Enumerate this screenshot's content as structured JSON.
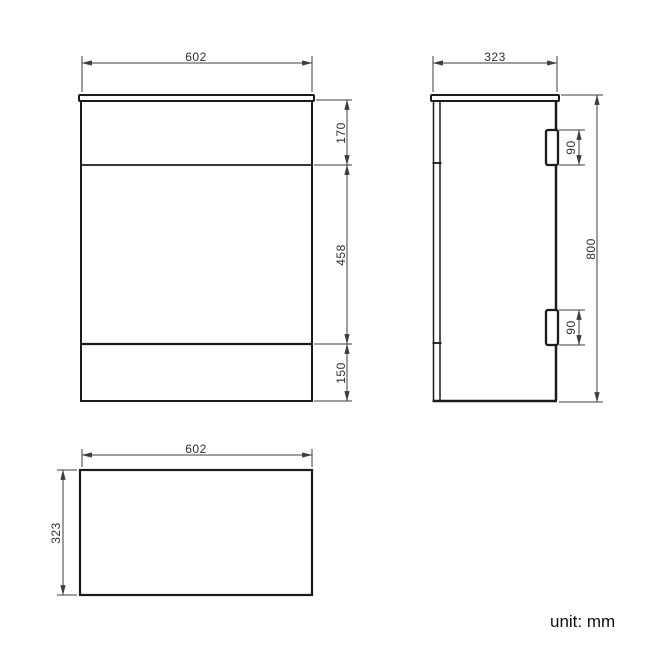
{
  "unit_note": "unit: mm",
  "front_view": {
    "width_label": "602",
    "sections": {
      "top": "170",
      "middle": "458",
      "bottom": "150"
    }
  },
  "side_view": {
    "depth_label": "323",
    "height_label": "800",
    "hinges": {
      "top": "90",
      "bottom": "90"
    }
  },
  "plan_view": {
    "width_label": "602",
    "depth_label": "323"
  },
  "colors": {
    "object_line": "#1b1b1b",
    "dimension_line": "#3d3d3d",
    "text": "#2f2f2f",
    "background": "#ffffff"
  }
}
